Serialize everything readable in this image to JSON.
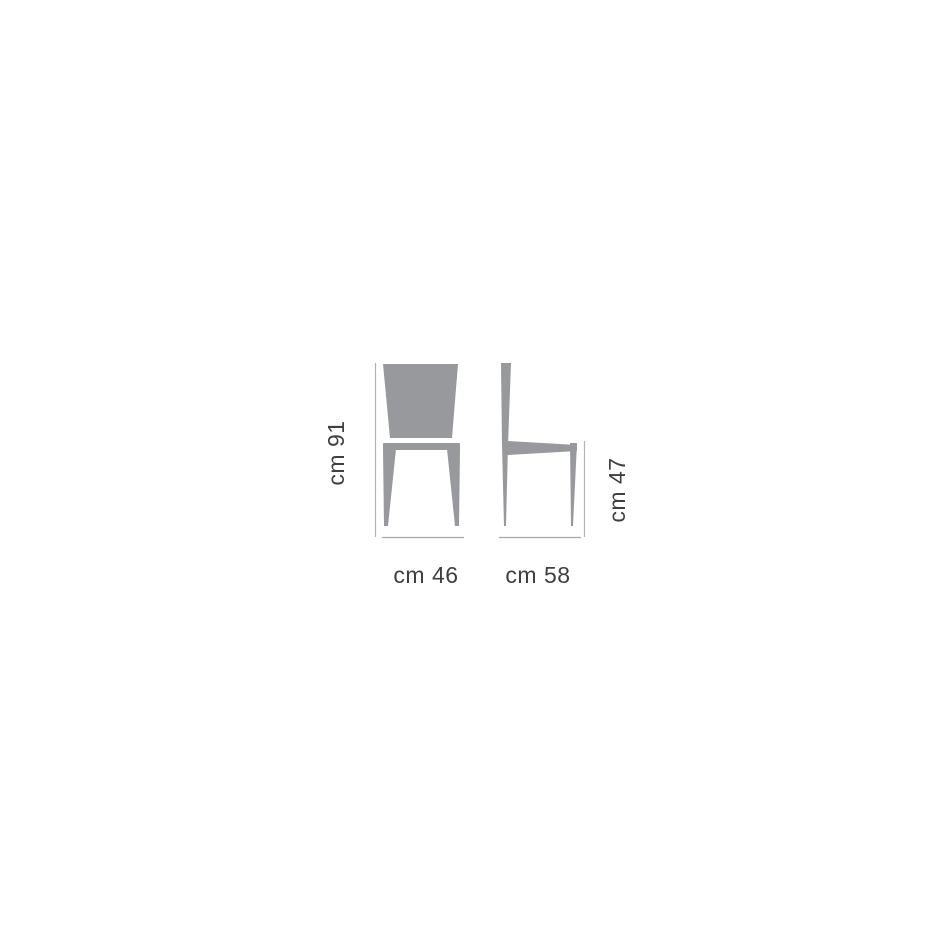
{
  "diagram": {
    "type": "furniture-dimension-drawing",
    "views": [
      {
        "name": "front-view"
      },
      {
        "name": "side-view"
      }
    ]
  },
  "dimensions": {
    "height_label": "cm 91",
    "width_label": "cm 46",
    "depth_label": "cm 58",
    "seat_height_label": "cm 47"
  },
  "colors": {
    "chair_fill": "#97999d",
    "dim_line": "#b0b2b4",
    "floor_line": "#a6a8aa",
    "text": "#3e3f41",
    "background": "#ffffff"
  }
}
